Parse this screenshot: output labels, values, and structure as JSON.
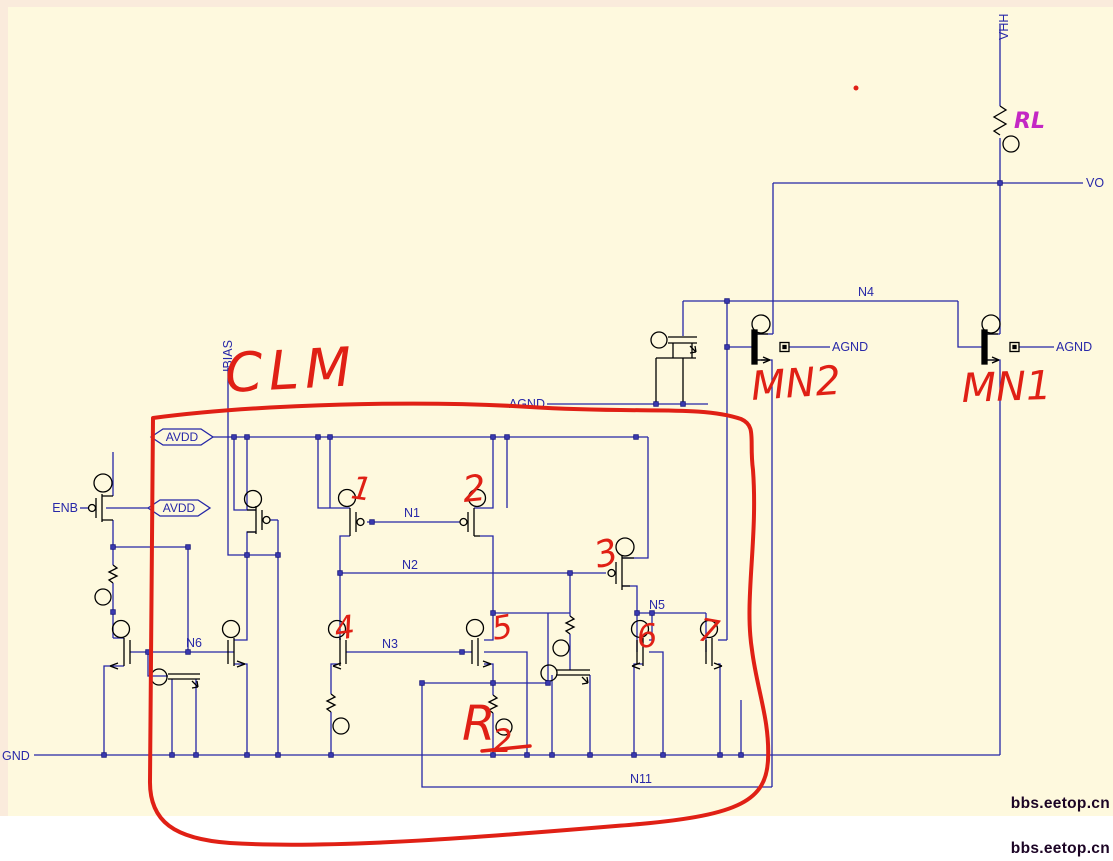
{
  "schematic": {
    "ports": {
      "vhh": "VHH",
      "vo": "VO",
      "gnd": "GND",
      "enb": "ENB",
      "ibias": "IBIAS"
    },
    "pins": {
      "avdd_rail": "AVDD",
      "avdd_enb": "AVDD"
    },
    "agnd": {
      "cap": "AGND",
      "mn2": "AGND",
      "mn1": "AGND"
    },
    "nets": {
      "n1": "N1",
      "n2": "N2",
      "n3": "N3",
      "n4": "N4",
      "n5": "N5",
      "n6": "N6",
      "n11": "N11"
    },
    "colors": {
      "background": "#FEF9DE",
      "wire": "#2527A6",
      "device": "#000000",
      "annotation_red": "#E02015",
      "annotation_magenta": "#C428C4",
      "watermark": "#1C0425"
    }
  },
  "annotations_red": {
    "block_label": "CLM",
    "device_numbers": [
      "1",
      "2",
      "3",
      "4",
      "5",
      "6",
      "7"
    ],
    "mn2": "MN2",
    "mn1": "MN1",
    "resistor": "R",
    "resistor_sub": "2"
  },
  "annotations_magenta": {
    "load_resistor": "RL"
  },
  "watermarks": [
    "bbs.eetop.cn",
    "bbs.eetop.cn"
  ]
}
